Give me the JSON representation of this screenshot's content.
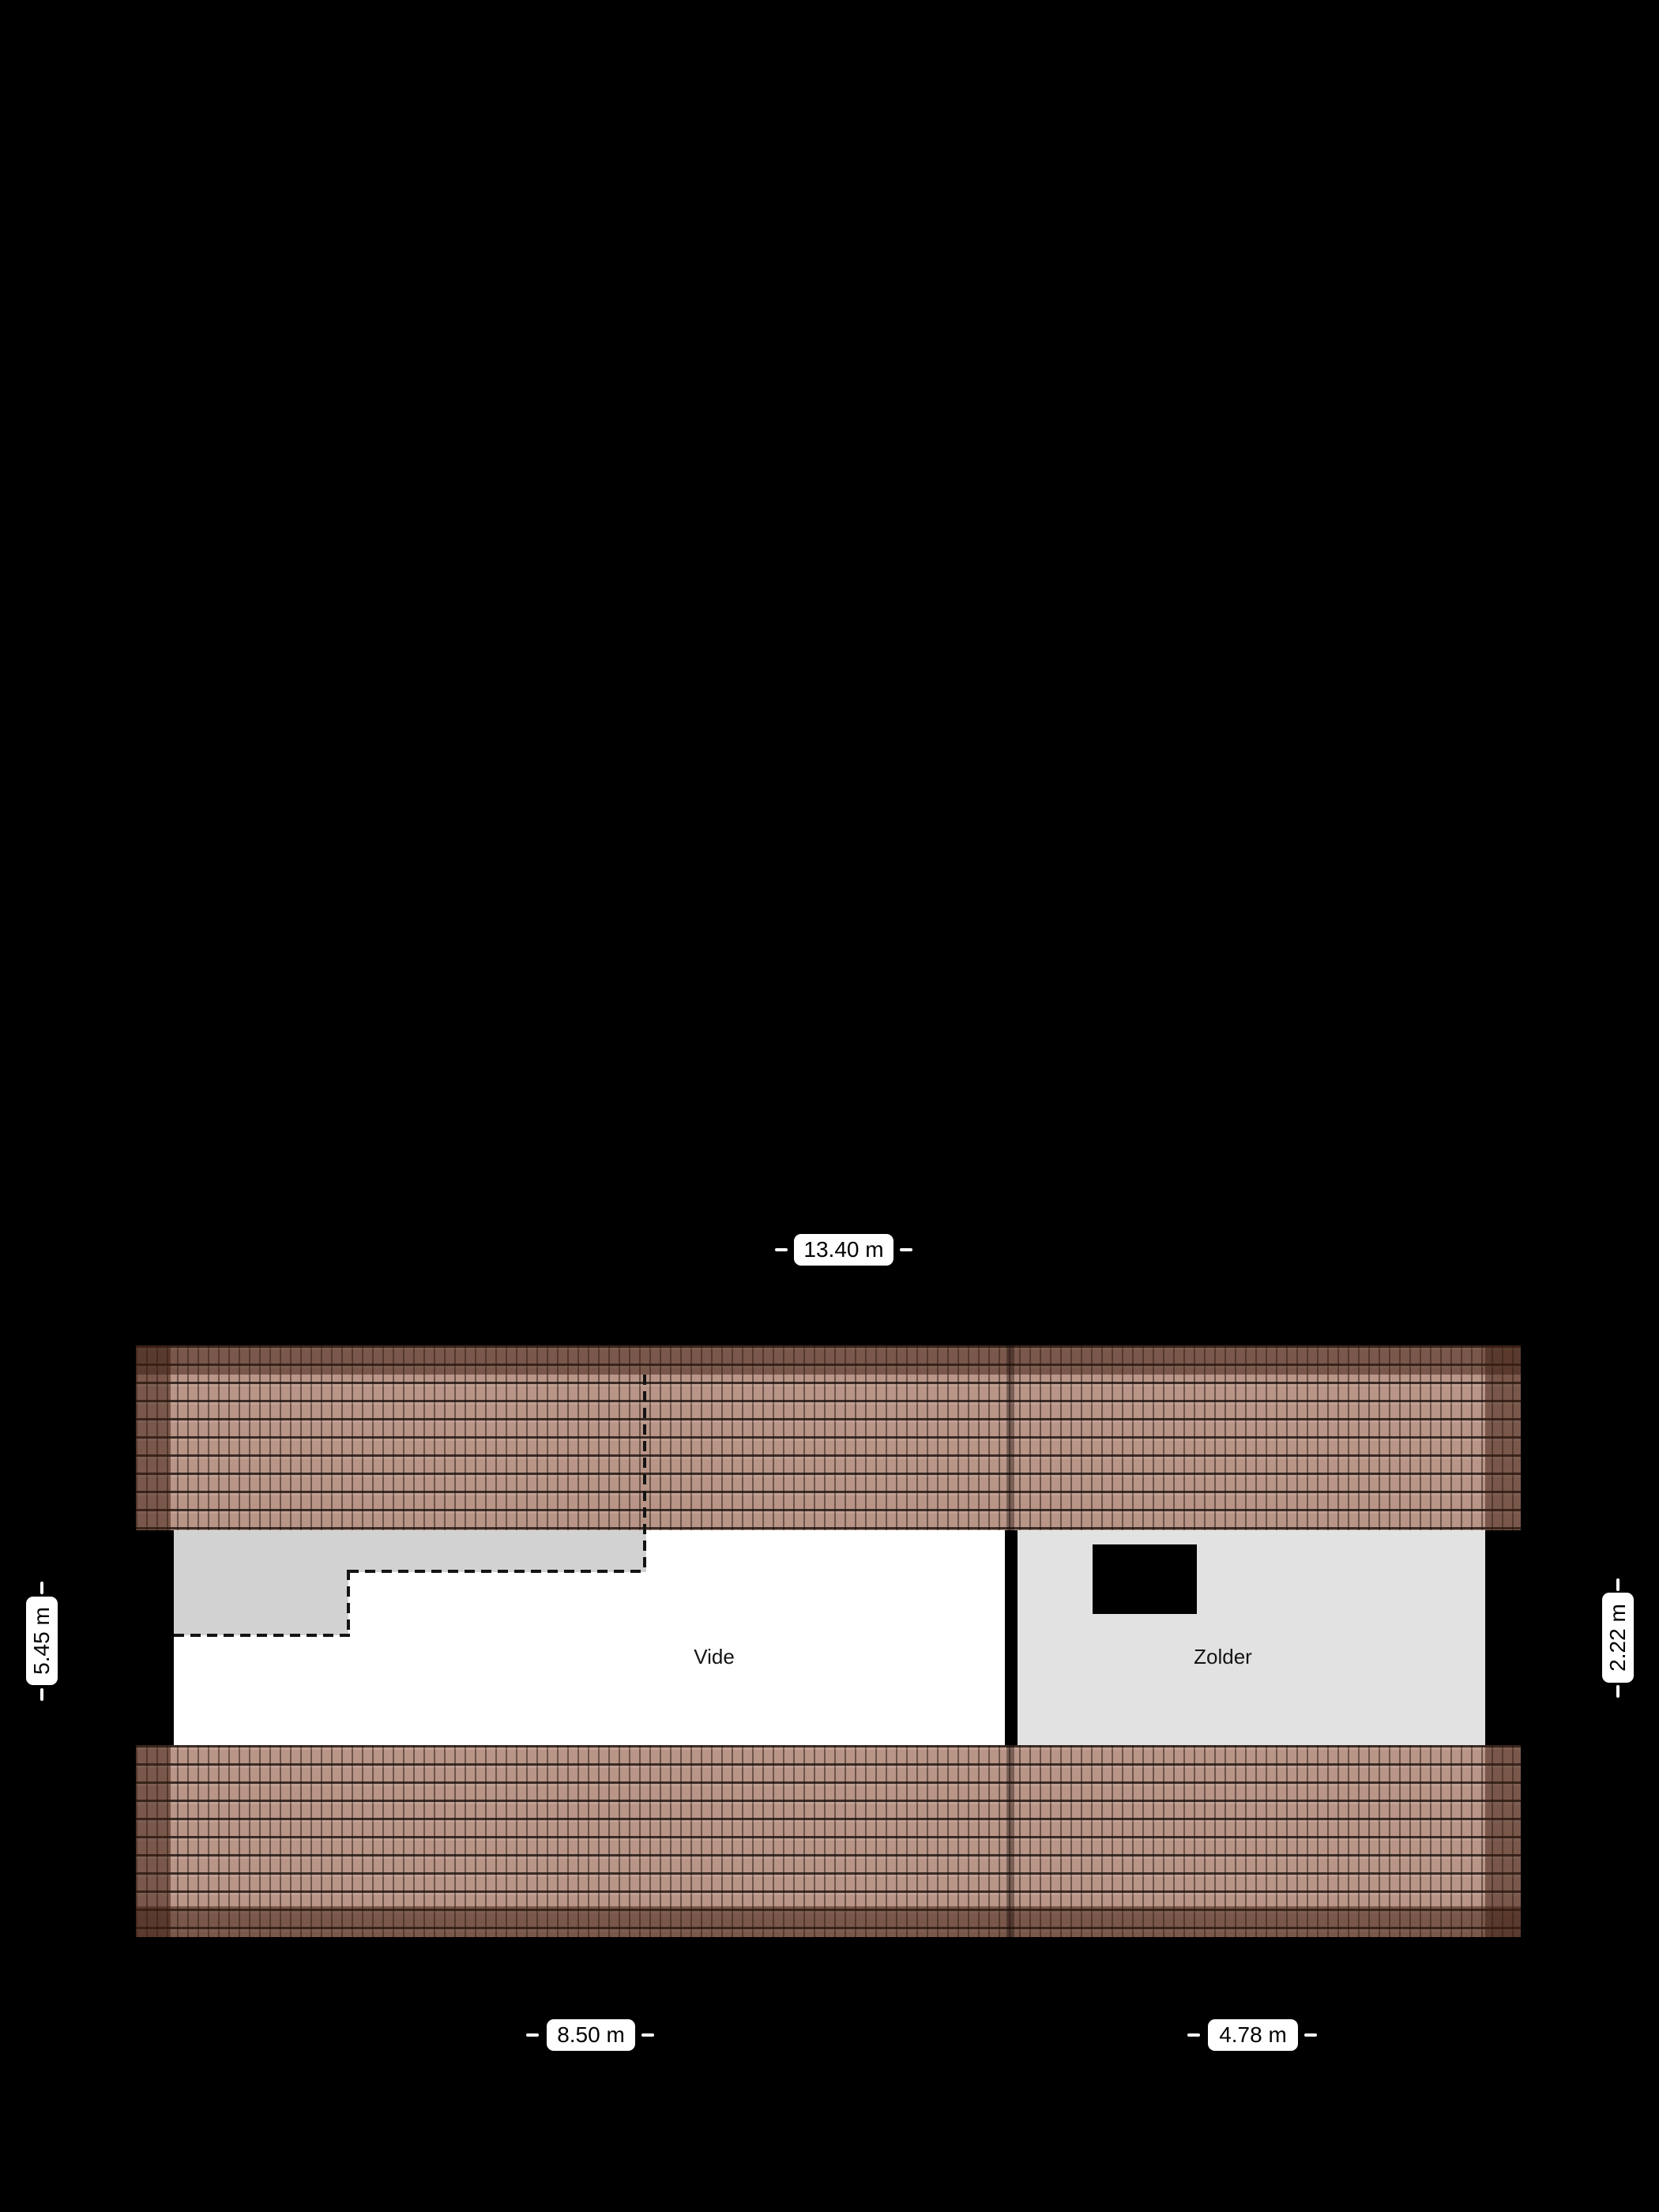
{
  "floorplan": {
    "floor_name": "attic-floorplan",
    "rooms": [
      {
        "name": "Vide"
      },
      {
        "name": "Zolder"
      }
    ],
    "dimensions": {
      "total_width": "13.40 m",
      "left_depth": "5.45 m",
      "right_depth": "2.22 m",
      "vide_width": "8.50 m",
      "zolder_width": "4.78 m"
    },
    "colors": {
      "background": "#000000",
      "roof_tile_light": "#ab8170",
      "roof_tile_edge": "#6f4f42",
      "vide_fill": "#ffffff",
      "landing_fill": "#d2d2d2",
      "zolder_fill": "#e2e2e2",
      "wall": "#000000",
      "dashed_line": "#141414",
      "label_background": "#ffffff",
      "label_text": "#000000"
    }
  }
}
